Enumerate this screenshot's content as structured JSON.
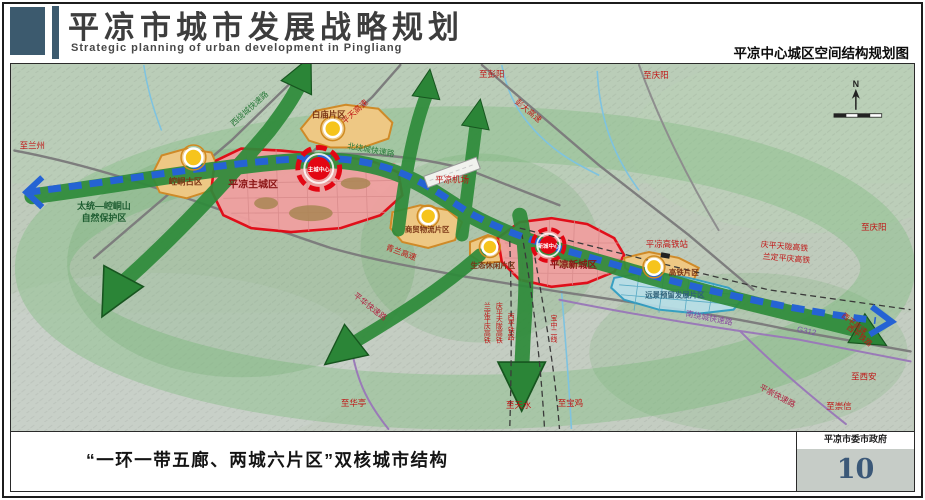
{
  "header": {
    "title": "平凉市城市发展战略规划",
    "subtitle": "Strategic planning of urban development in Pingliang",
    "caption_right": "平凉中心城区空间结构规划图"
  },
  "footer": {
    "caption": "“一环一带五廊、两城六片区”双核城市结构",
    "agency": "平凉市委市政府",
    "page_number": "10"
  },
  "colors": {
    "accent": "#3c5a6e",
    "main_city_red": "#e30613",
    "district_orange": "#eec884",
    "corridor_green": "#2e8b3a",
    "belt_blue": "#2563d4",
    "reserved_blue": "#b8e0ea",
    "page_number_color": "#3b5878"
  },
  "map": {
    "compass": "N",
    "labels": [
      {
        "name": "label-to-lanzhou",
        "text": "至兰州",
        "x": 20,
        "y": 85,
        "size": 8.5,
        "color": "#c01515"
      },
      {
        "name": "label-to-pengyang",
        "text": "至彭阳",
        "x": 482,
        "y": 13,
        "size": 8.5,
        "color": "#c01515"
      },
      {
        "name": "label-to-qingyang-top",
        "text": "至庆阳",
        "x": 647,
        "y": 14,
        "size": 8.5,
        "color": "#c01515"
      },
      {
        "name": "label-to-qingyang-right",
        "text": "至庆阳",
        "x": 866,
        "y": 167,
        "size": 8.5,
        "color": "#c01515"
      },
      {
        "name": "label-to-xian",
        "text": "至西安",
        "x": 856,
        "y": 317,
        "size": 8.5,
        "color": "#c01515"
      },
      {
        "name": "label-to-chongxin",
        "text": "至崇信",
        "x": 831,
        "y": 347,
        "size": 8.5,
        "color": "#c01515"
      },
      {
        "name": "label-to-huating",
        "text": "至华亭",
        "x": 343,
        "y": 344,
        "size": 8.5,
        "color": "#c01515"
      },
      {
        "name": "label-to-tianshui",
        "text": "至天水",
        "x": 509,
        "y": 346,
        "size": 8.5,
        "color": "#c01515"
      },
      {
        "name": "label-to-baoji",
        "text": "至宝鸡",
        "x": 561,
        "y": 344,
        "size": 8.5,
        "color": "#c01515"
      },
      {
        "name": "road-label-pingtian-expwy",
        "text": "平天高速",
        "x": 346,
        "y": 50,
        "size": 8,
        "color": "#c01515",
        "rot": -42
      },
      {
        "name": "road-label-pengda-expwy",
        "text": "彭大高速",
        "x": 517,
        "y": 49,
        "size": 8,
        "color": "#c01515",
        "rot": 40
      },
      {
        "name": "road-label-qinglan-expwy",
        "text": "青兰高速",
        "x": 390,
        "y": 192,
        "size": 8,
        "color": "#c01515",
        "rot": 20
      },
      {
        "name": "road-label-west-ring",
        "text": "西绕城快速路",
        "x": 240,
        "y": 47,
        "size": 8,
        "color": "#2a7a3a",
        "rot": -42
      },
      {
        "name": "road-label-north-ring",
        "text": "北绕城快速路",
        "x": 360,
        "y": 89,
        "size": 8,
        "color": "#2a7a3a",
        "rot": 10
      },
      {
        "name": "road-label-south-ring",
        "text": "南绕城快速路",
        "x": 700,
        "y": 258,
        "size": 8,
        "color": "#8a4aa0",
        "rot": 11
      },
      {
        "name": "road-label-pinghua-expwy",
        "text": "平华快速路",
        "x": 358,
        "y": 246,
        "size": 8,
        "color": "#b02040",
        "rot": 38
      },
      {
        "name": "road-label-pingchong-expwy",
        "text": "平崇快速路",
        "x": 768,
        "y": 336,
        "size": 8,
        "color": "#b02040",
        "rot": 28
      },
      {
        "name": "road-label-g312",
        "text": "G312",
        "x": 798,
        "y": 271,
        "size": 8,
        "color": "#7a55a8",
        "rot": 12
      },
      {
        "name": "rail-label-qpt-hsr",
        "text": "庆平天陇高铁",
        "x": 776,
        "y": 186,
        "size": 8,
        "color": "#c01515",
        "rot": 5
      },
      {
        "name": "rail-label-ldpq-hsr",
        "text": "兰定平庆高铁",
        "x": 778,
        "y": 198,
        "size": 8,
        "color": "#c01515",
        "rot": 5
      },
      {
        "name": "label-hsr-station",
        "text": "平凉高铁站",
        "x": 658,
        "y": 184,
        "size": 8.5,
        "color": "#c01515"
      },
      {
        "name": "label-airport",
        "text": "平凉机场",
        "x": 442,
        "y": 119,
        "size": 8.5,
        "color": "#c01515"
      },
      {
        "name": "rail-label-ldpq-south",
        "text": "兰定平庆高铁",
        "x": 477,
        "y": 260,
        "size": 7,
        "color": "#c01515",
        "vertical": true
      },
      {
        "name": "rail-label-qpt-south",
        "text": "庆平天陇高铁",
        "x": 489,
        "y": 260,
        "size": 7,
        "color": "#c01515",
        "vertical": true
      },
      {
        "name": "rail-label-xiping",
        "text": "西平铁路",
        "x": 501,
        "y": 264,
        "size": 7,
        "color": "#c01515",
        "vertical": true
      },
      {
        "name": "rail-label-baozhong",
        "text": "宝中二线",
        "x": 544,
        "y": 266,
        "size": 7,
        "color": "#c01515",
        "vertical": true
      },
      {
        "name": "road-label-xiping-expwy",
        "text": "西平高速",
        "x": 845,
        "y": 263,
        "size": 7.5,
        "color": "#c01515",
        "rot": 38
      },
      {
        "name": "rail-label-xiping-east",
        "text": "西平铁路",
        "x": 850,
        "y": 275,
        "size": 7.5,
        "color": "#c01515",
        "rot": 38
      },
      {
        "name": "label-nature-reserve-1",
        "text": "太统—崆峒山",
        "x": 92,
        "y": 146,
        "size": 9,
        "color": "#1d5c30",
        "bold": true
      },
      {
        "name": "label-nature-reserve-2",
        "text": "自然保护区",
        "x": 92,
        "y": 158,
        "size": 9,
        "color": "#1d5c30",
        "bold": true
      },
      {
        "name": "district-label-kongtong",
        "text": "崆峒古区",
        "x": 174,
        "y": 121,
        "size": 8.5,
        "color": "#7a3515",
        "bold": true
      },
      {
        "name": "district-label-baimiao",
        "text": "白庙片区",
        "x": 318,
        "y": 54,
        "size": 8.5,
        "color": "#7a3515",
        "bold": true
      },
      {
        "name": "city-label-main-city",
        "text": "平凉主城区",
        "x": 242,
        "y": 124,
        "size": 10,
        "color": "#8b1515",
        "bold": true
      },
      {
        "name": "center-label-main",
        "text": "主城中心",
        "x": 308,
        "y": 108,
        "size": 5.5,
        "color": "#ffffff",
        "bold": true
      },
      {
        "name": "district-label-trade-logistics",
        "text": "商贸物流片区",
        "x": 417,
        "y": 169,
        "size": 7.5,
        "color": "#7a3515",
        "bold": true
      },
      {
        "name": "district-label-eco-leisure",
        "text": "生态休闲片区",
        "x": 483,
        "y": 205,
        "size": 7.5,
        "color": "#7a3515",
        "bold": true
      },
      {
        "name": "city-label-new-city",
        "text": "平凉新城区",
        "x": 564,
        "y": 205,
        "size": 9.5,
        "color": "#8b1515",
        "bold": true
      },
      {
        "name": "center-label-new",
        "text": "新城中心",
        "x": 539,
        "y": 185,
        "size": 5.5,
        "color": "#ffffff",
        "bold": true
      },
      {
        "name": "district-label-hsr",
        "text": "高铁片区",
        "x": 675,
        "y": 212,
        "size": 7.5,
        "color": "#7a3515",
        "bold": true
      },
      {
        "name": "district-label-reserved",
        "text": "远景预留发展片区",
        "x": 666,
        "y": 235,
        "size": 7.5,
        "color": "#2f6178",
        "bold": true
      },
      {
        "name": "compass-n",
        "text": "N",
        "x": 848,
        "y": 23,
        "size": 9,
        "color": "#222222",
        "bold": true
      }
    ]
  }
}
